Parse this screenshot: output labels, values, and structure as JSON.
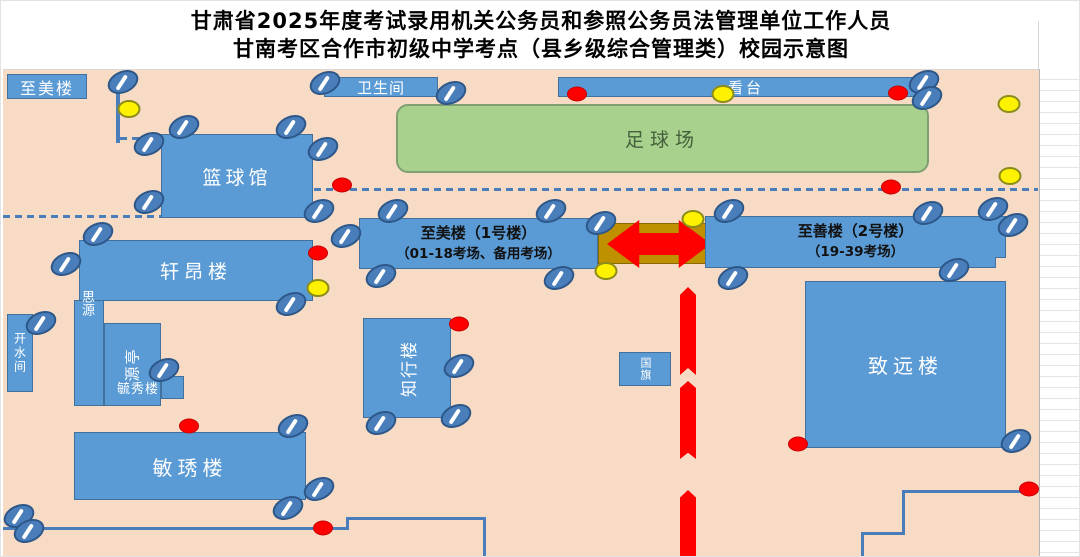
{
  "title": {
    "line1": "甘肃省2025年度考试录用机关公务员和参照公务员法管理单位工作人员",
    "line2": "甘南考区合作市初级中学考点（县乡级综合管理类）校园示意图"
  },
  "areas": {
    "football_field": {
      "label": "足球场"
    }
  },
  "buildings": {
    "zhimei_sign": {
      "label": "至美楼"
    },
    "weishengjian": {
      "label": "卫生间"
    },
    "kantai": {
      "label": "看台"
    },
    "lanqiuguan": {
      "label": "篮球馆"
    },
    "xuanang": {
      "label": "轩昂楼"
    },
    "siyuan": {
      "label": "思源"
    },
    "yuanting": {
      "label": "源亭"
    },
    "yuxiu": {
      "label": "毓秀楼"
    },
    "kaishuijian": {
      "label": "开水间"
    },
    "minxiu": {
      "label": "敏琇楼"
    },
    "zhixing": {
      "label": "知行楼"
    },
    "guoqi": {
      "label": "国旗"
    },
    "zhiyuan": {
      "label": "致远楼"
    },
    "zhimei_no1": {
      "line1": "至美楼（1号楼）",
      "line2": "（01-18考场、备用考场）"
    },
    "zhishan_no2": {
      "line1": "至善楼（2号楼）",
      "line2": "（19-39考场）"
    }
  },
  "colors": {
    "map_background": "#f8dbc5",
    "building_fill": "#5b9bd5",
    "building_border": "#41719c",
    "field_fill": "#a9d18e",
    "route_red": "#fe0000",
    "passage_olive": "#bf9000",
    "line_blue": "#4a7ebb",
    "yellow_marker": "#fef200"
  },
  "markers": [
    {
      "type": "blue-oval",
      "x": 122,
      "y": 81
    },
    {
      "type": "blue-oval",
      "x": 183,
      "y": 126
    },
    {
      "type": "blue-oval",
      "x": 290,
      "y": 126
    },
    {
      "type": "blue-oval",
      "x": 148,
      "y": 143
    },
    {
      "type": "blue-oval",
      "x": 322,
      "y": 148
    },
    {
      "type": "blue-oval",
      "x": 148,
      "y": 201
    },
    {
      "type": "blue-oval",
      "x": 318,
      "y": 210
    },
    {
      "type": "blue-oval",
      "x": 97,
      "y": 233
    },
    {
      "type": "blue-oval",
      "x": 65,
      "y": 263
    },
    {
      "type": "blue-oval",
      "x": 40,
      "y": 322
    },
    {
      "type": "blue-oval",
      "x": 290,
      "y": 303
    },
    {
      "type": "blue-oval",
      "x": 163,
      "y": 369
    },
    {
      "type": "blue-oval",
      "x": 324,
      "y": 82
    },
    {
      "type": "blue-oval",
      "x": 450,
      "y": 92
    },
    {
      "type": "blue-oval",
      "x": 392,
      "y": 210
    },
    {
      "type": "blue-oval",
      "x": 550,
      "y": 210
    },
    {
      "type": "blue-oval",
      "x": 345,
      "y": 235
    },
    {
      "type": "blue-oval",
      "x": 380,
      "y": 275
    },
    {
      "type": "blue-oval",
      "x": 558,
      "y": 277
    },
    {
      "type": "blue-oval",
      "x": 600,
      "y": 222
    },
    {
      "type": "blue-oval",
      "x": 923,
      "y": 81
    },
    {
      "type": "blue-oval",
      "x": 926,
      "y": 97
    },
    {
      "type": "blue-oval",
      "x": 728,
      "y": 210
    },
    {
      "type": "blue-oval",
      "x": 927,
      "y": 212
    },
    {
      "type": "blue-oval",
      "x": 992,
      "y": 208
    },
    {
      "type": "blue-oval",
      "x": 1012,
      "y": 224
    },
    {
      "type": "blue-oval",
      "x": 732,
      "y": 277
    },
    {
      "type": "blue-oval",
      "x": 953,
      "y": 269
    },
    {
      "type": "blue-oval",
      "x": 1015,
      "y": 440
    },
    {
      "type": "blue-oval",
      "x": 458,
      "y": 365
    },
    {
      "type": "blue-oval",
      "x": 455,
      "y": 415
    },
    {
      "type": "blue-oval",
      "x": 380,
      "y": 422
    },
    {
      "type": "blue-oval",
      "x": 292,
      "y": 425
    },
    {
      "type": "blue-oval",
      "x": 318,
      "y": 488
    },
    {
      "type": "blue-oval",
      "x": 287,
      "y": 507
    },
    {
      "type": "blue-oval",
      "x": 18,
      "y": 515
    },
    {
      "type": "blue-oval",
      "x": 28,
      "y": 530
    },
    {
      "type": "yellow-dot",
      "x": 128,
      "y": 108
    },
    {
      "type": "yellow-dot",
      "x": 722,
      "y": 93
    },
    {
      "type": "yellow-dot",
      "x": 1008,
      "y": 103
    },
    {
      "type": "yellow-dot",
      "x": 1009,
      "y": 175
    },
    {
      "type": "yellow-dot",
      "x": 692,
      "y": 218
    },
    {
      "type": "yellow-dot",
      "x": 605,
      "y": 270
    },
    {
      "type": "yellow-dot",
      "x": 317,
      "y": 287
    },
    {
      "type": "red-dot",
      "x": 576,
      "y": 93
    },
    {
      "type": "red-dot",
      "x": 897,
      "y": 92
    },
    {
      "type": "red-dot",
      "x": 341,
      "y": 184
    },
    {
      "type": "red-dot",
      "x": 890,
      "y": 186
    },
    {
      "type": "red-dot",
      "x": 317,
      "y": 252
    },
    {
      "type": "red-dot",
      "x": 458,
      "y": 323
    },
    {
      "type": "red-dot",
      "x": 188,
      "y": 425
    },
    {
      "type": "red-dot",
      "x": 322,
      "y": 527
    },
    {
      "type": "red-dot",
      "x": 797,
      "y": 443
    },
    {
      "type": "red-dot",
      "x": 1028,
      "y": 488
    }
  ]
}
